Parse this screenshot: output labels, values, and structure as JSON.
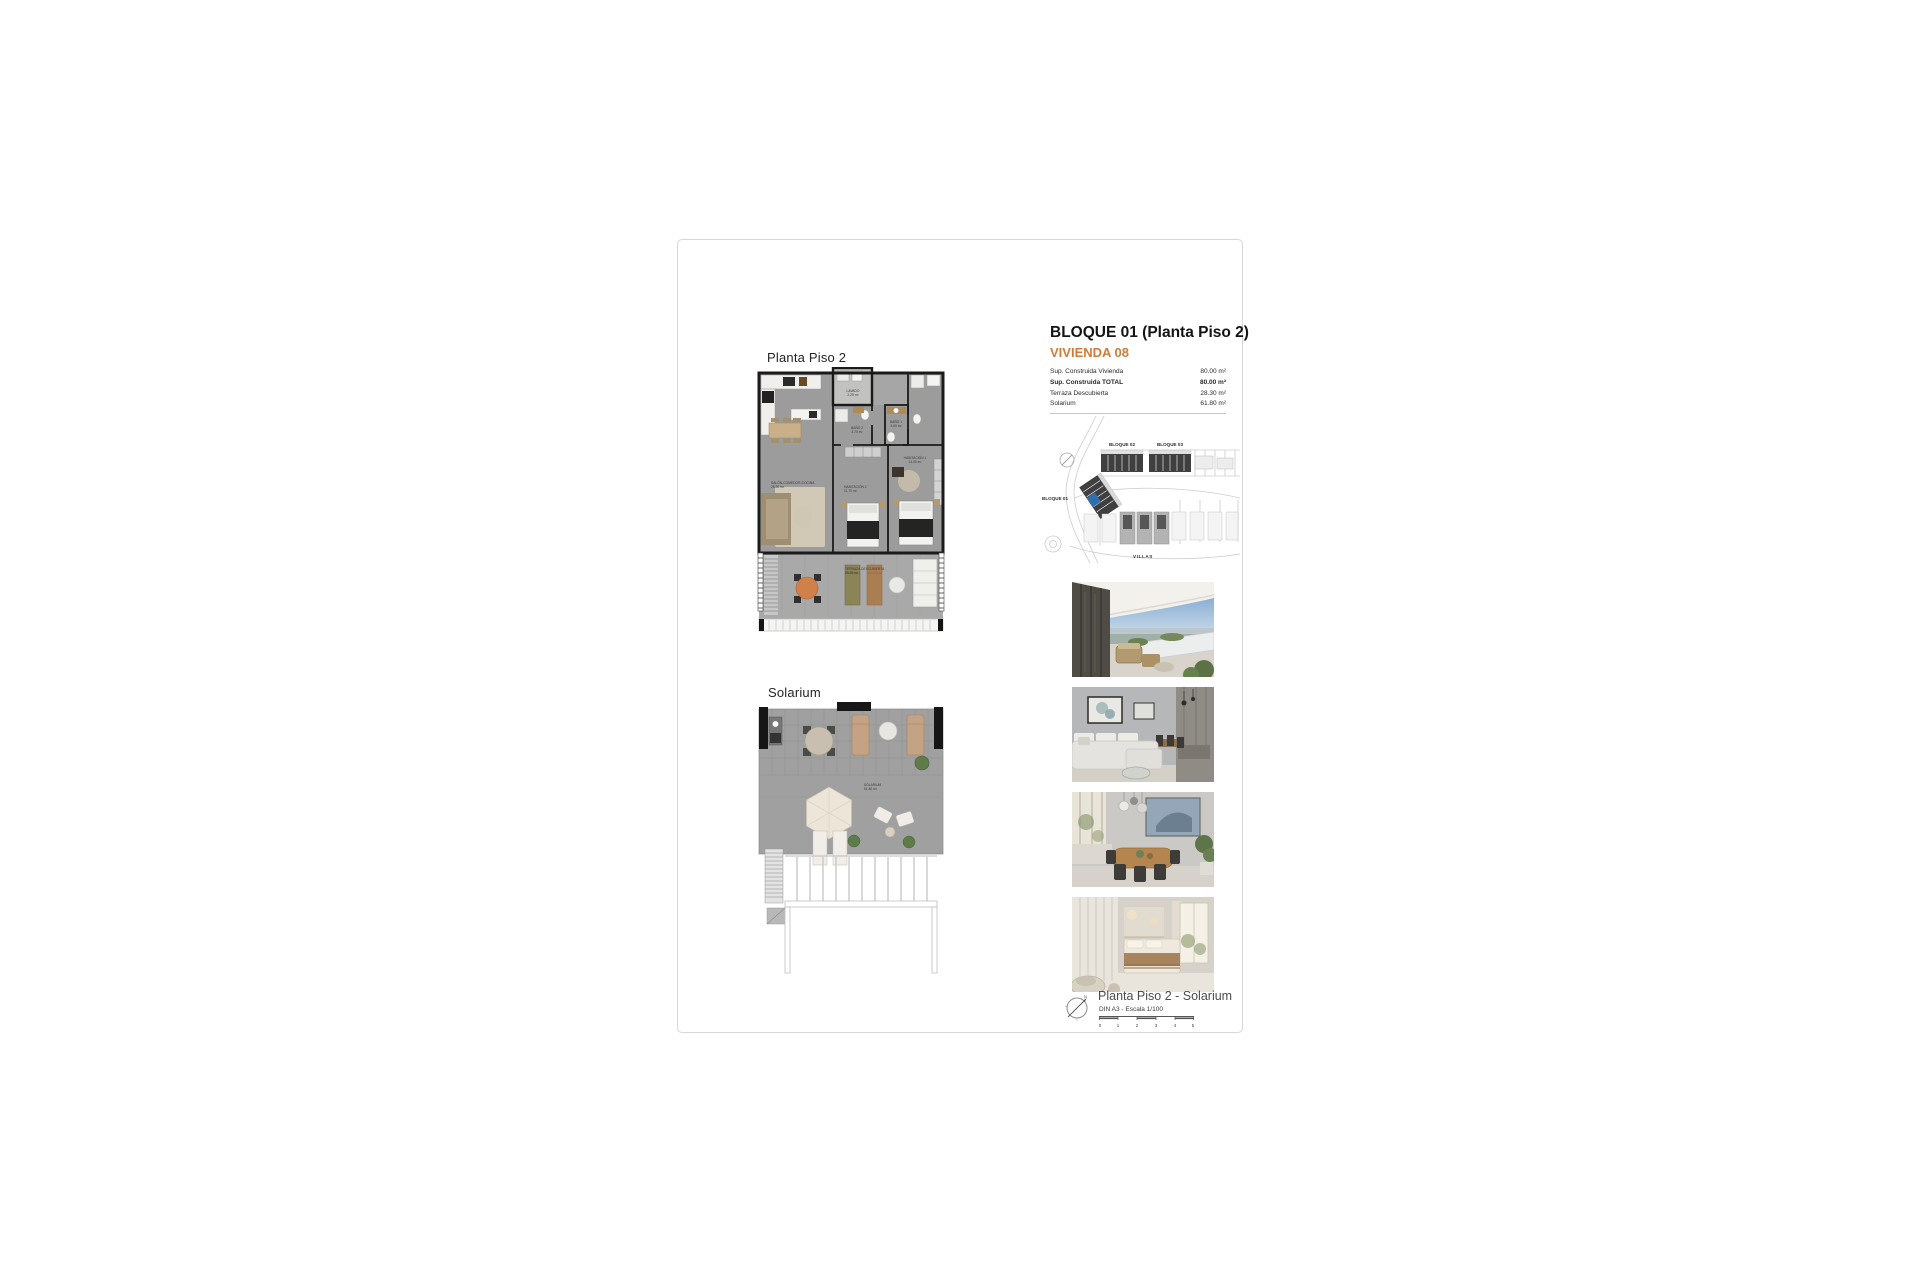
{
  "colors": {
    "accent_orange": "#ce7b3c",
    "highlight_blue": "#2f6fad",
    "page_border": "#d8d8d8"
  },
  "header": {
    "title": "BLOQUE 01  (Planta Piso 2)",
    "subtitle": "VIVIENDA 08"
  },
  "surfaces": {
    "rows": [
      {
        "label": "Sup. Construida Vivienda",
        "value": "80.00 m²"
      },
      {
        "label": "Sup. Construida TOTAL",
        "value": "80.00 m²"
      },
      {
        "label": "Terraza Descubierta",
        "value": "28.30 m²"
      },
      {
        "label": "Solarium",
        "value": "61.80 m²"
      }
    ]
  },
  "site_plan": {
    "labels": {
      "bloque02": "BLOQUE 02",
      "bloque03": "BLOQUE 03",
      "bloque01": "BLOQUE 01",
      "villas": "VILLAS"
    }
  },
  "plans": {
    "plan1": {
      "title": "Planta Piso 2",
      "rooms": [
        {
          "name": "LAVADO",
          "area": "2.25 m²"
        },
        {
          "name": "BAÑO 2",
          "area": "3.70 m²"
        },
        {
          "name": "BAÑO 1",
          "area": "4.60 m²"
        },
        {
          "name": "HABITACIÓN 1",
          "area": "14.00 m²"
        },
        {
          "name": "HABITACIÓN 2",
          "area": "11.70 m²"
        },
        {
          "name": "SALÓN-COMEDOR-COCINA",
          "area": "25.90 m²"
        },
        {
          "name": "TERRAZA DESCUBIERTA",
          "area": "28.30 m²"
        }
      ]
    },
    "plan2": {
      "title": "Solarium",
      "rooms": [
        {
          "name": "SOLARIUM",
          "area": "61.80 m²"
        }
      ]
    }
  },
  "photos": [
    {
      "name": "terrace-exterior-view"
    },
    {
      "name": "living-room-interior"
    },
    {
      "name": "dining-area-interior"
    },
    {
      "name": "bedroom-interior"
    }
  ],
  "footer": {
    "title": "Planta Piso 2 - Solarium",
    "scale_note": "DIN A3 - Escala 1/100",
    "scale_ticks": [
      "0",
      "1",
      "2",
      "3",
      "4",
      "5"
    ],
    "compass_north": "N"
  }
}
